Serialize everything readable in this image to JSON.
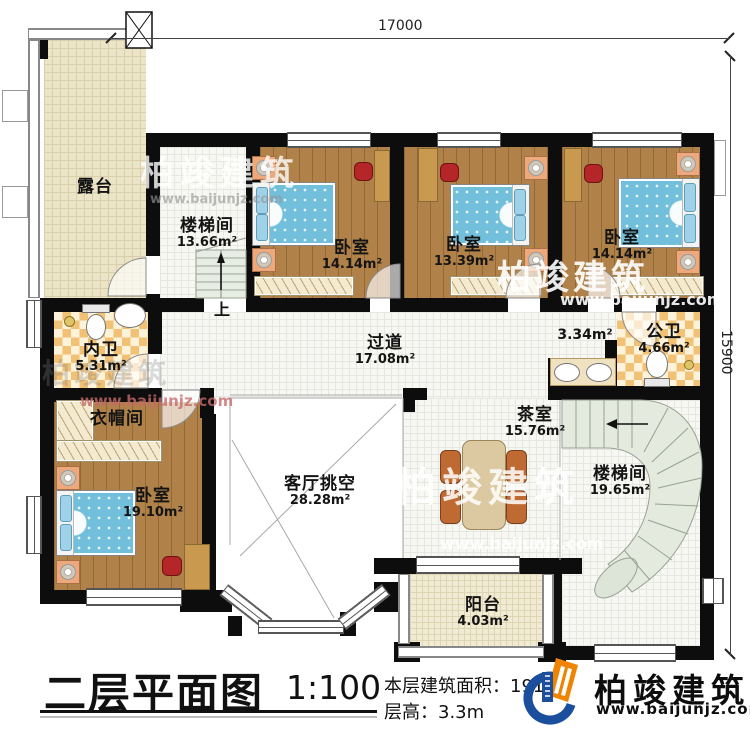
{
  "dimensions": {
    "top": "17000",
    "right": "15900"
  },
  "rooms": [
    {
      "id": "terrace",
      "name": "露台",
      "area": ""
    },
    {
      "id": "stair1",
      "name": "楼梯间",
      "area": "13.66m²"
    },
    {
      "id": "bedroom1",
      "name": "卧室",
      "area": "14.14m²"
    },
    {
      "id": "bedroom2",
      "name": "卧室",
      "area": "13.39m²"
    },
    {
      "id": "bedroom3",
      "name": "卧室",
      "area": "14.14m²"
    },
    {
      "id": "innerbath",
      "name": "内卫",
      "area": "5.31m²"
    },
    {
      "id": "corridor",
      "name": "过道",
      "area": "17.08m²"
    },
    {
      "id": "washarea",
      "name": "",
      "area": "3.34m²"
    },
    {
      "id": "pubbath",
      "name": "公卫",
      "area": "4.66m²"
    },
    {
      "id": "cloak",
      "name": "衣帽间",
      "area": ""
    },
    {
      "id": "bedroom4",
      "name": "卧室",
      "area": "19.10m²"
    },
    {
      "id": "living",
      "name": "客厅挑空",
      "area": "28.28m²"
    },
    {
      "id": "tearoom",
      "name": "茶室",
      "area": "15.76m²"
    },
    {
      "id": "stair2",
      "name": "楼梯间",
      "area": "19.65m²"
    },
    {
      "id": "balcony",
      "name": "阳台",
      "area": "4.03m²"
    }
  ],
  "stairs": {
    "up_label": "上"
  },
  "watermarks": {
    "brand": "柏竣建筑",
    "url": "www.baijunjz.com"
  },
  "title_block": {
    "title": "二层平面图",
    "scale": "1:100",
    "area_line": "本层建筑面积：191.5",
    "floor_height_line": "层高：3.3m"
  },
  "logo": {
    "name": "柏竣建筑",
    "url": "www.baijunjz.com"
  },
  "colors": {
    "wall": "#0d0d0d",
    "wood": "#b0824a",
    "bed_blue": "#72bfdc",
    "checker": "#f1c176",
    "logo_blue": "#1b4f9e",
    "logo_orange": "#f08300",
    "watermark_red": "#c46a6a"
  }
}
